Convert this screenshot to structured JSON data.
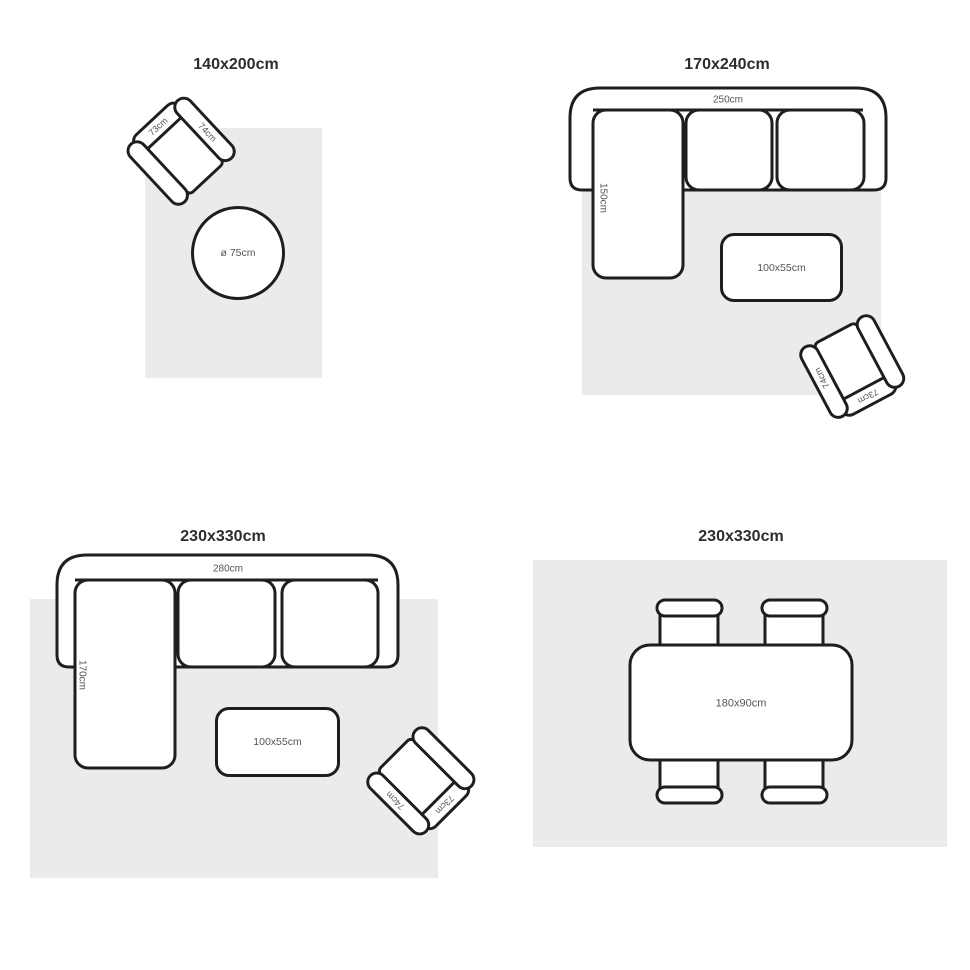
{
  "colors": {
    "background": "#ffffff",
    "rug_fill": "#ebebeb",
    "outline": "#1e1e1e",
    "label_text": "#555555",
    "title_text": "#2d2d2d"
  },
  "panels": [
    {
      "title": "140x200cm",
      "armchair": {
        "back_label": "73cm",
        "arm_label": "74cm"
      },
      "round_table": {
        "label": "ø 75cm"
      }
    },
    {
      "title": "170x240cm",
      "sofa": {
        "width_label": "250cm",
        "depth_label": "150cm"
      },
      "coffee_table": {
        "label": "100x55cm"
      },
      "armchair": {
        "back_label": "73cm",
        "arm_label": "74cm"
      }
    },
    {
      "title": "230x330cm",
      "sofa": {
        "width_label": "280cm",
        "depth_label": "170cm"
      },
      "coffee_table": {
        "label": "100x55cm"
      },
      "armchair": {
        "back_label": "73cm",
        "arm_label": "74cm"
      }
    },
    {
      "title": "230x330cm",
      "dining_table": {
        "label": "180x90cm"
      }
    }
  ]
}
